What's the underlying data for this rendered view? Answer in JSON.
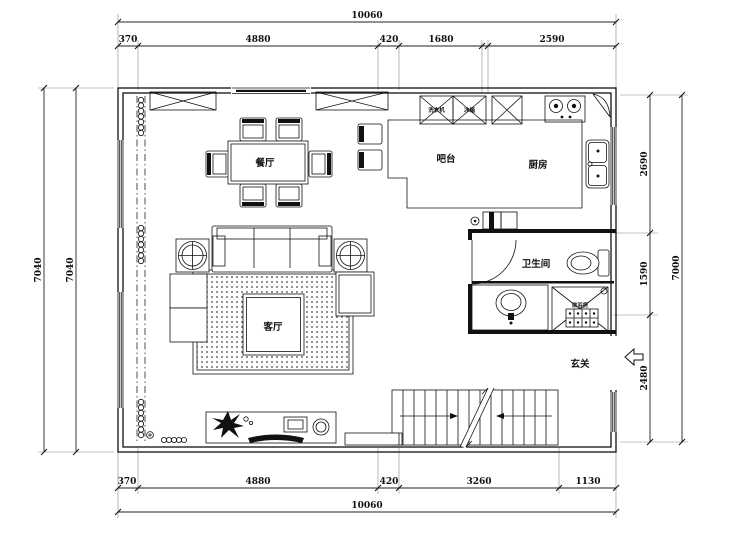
{
  "plan": {
    "rooms": {
      "dining": "餐厅",
      "bar": "吧台",
      "kitchen": "厨房",
      "bathroom": "卫生间",
      "living": "客厅",
      "foyer": "玄关"
    },
    "fixtures": {
      "washer": "洗衣机",
      "fridge": "冰箱",
      "shower": "淋浴房"
    },
    "dims": {
      "top_total": "10060",
      "top_1": "370",
      "top_2": "4880",
      "top_3": "420",
      "top_4": "1680",
      "top_5": "2590",
      "bottom_total": "10060",
      "bottom_1": "370",
      "bottom_2": "4880",
      "bottom_3": "420",
      "bottom_4": "3260",
      "bottom_5": "1130",
      "left_1": "7040",
      "left_2": "7040",
      "right_1": "2690",
      "right_2": "1590",
      "right_3": "2480",
      "right_total": "7000"
    }
  }
}
